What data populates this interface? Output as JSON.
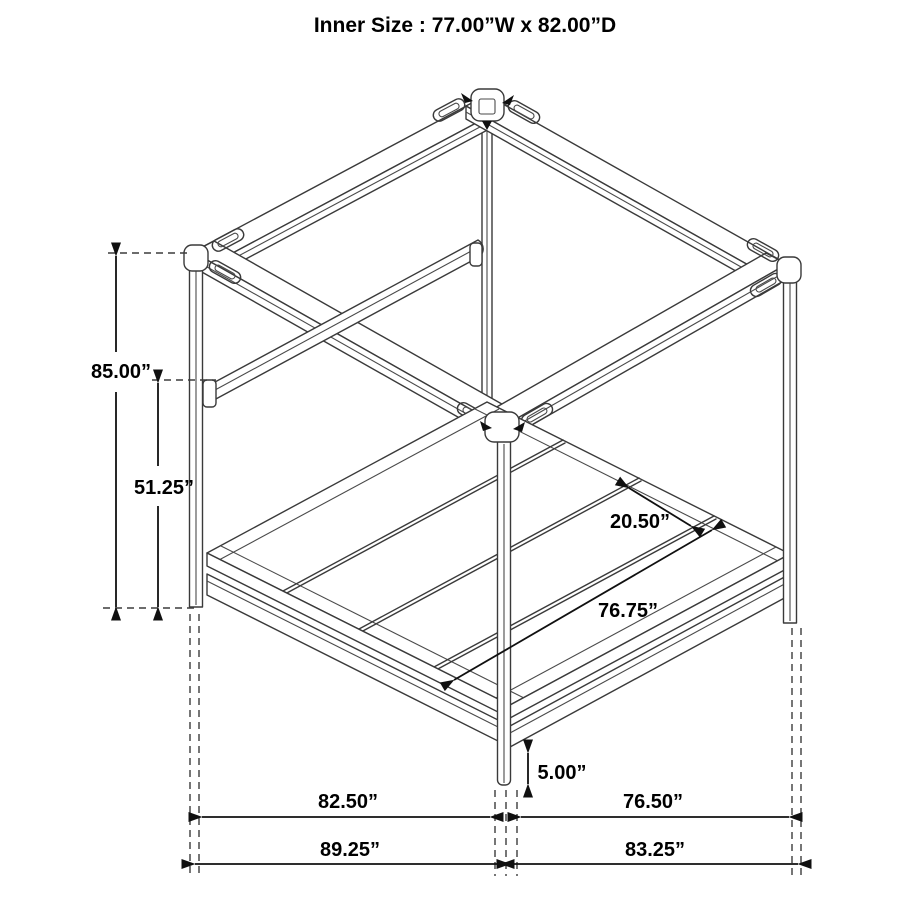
{
  "title": "Inner Size : 77.00”W x 82.00”D",
  "dims": {
    "post_height": "85.00”",
    "upper_rail_height": "51.25”",
    "slat_panel_width": "20.50”",
    "slat_length": "76.75”",
    "floor_clearance": "5.00”",
    "depth_inner": "82.50”",
    "width_inner": "76.50”",
    "depth_outer": "89.25”",
    "width_outer": "83.25”"
  }
}
